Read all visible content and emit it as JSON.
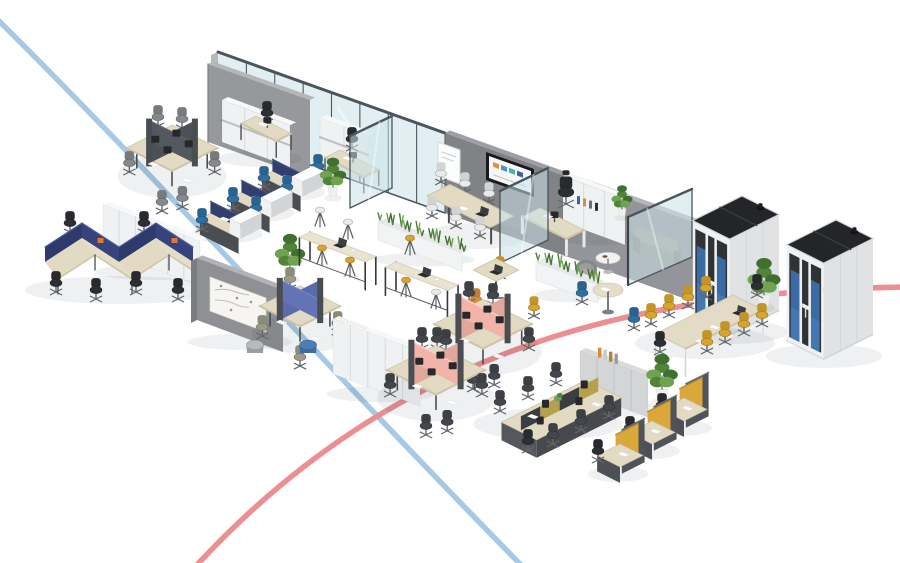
{
  "meta": {
    "width": 900,
    "height": 563,
    "background": "#ffffff"
  },
  "palette": {
    "line_blue": "#a6c9e6",
    "line_red": "#ec8f91",
    "wall_gray": "#94959a",
    "wall_gray_light": "#b7b8bb",
    "wall_dark": "#808286",
    "glass_fill": "rgba(203,226,232,0.55)",
    "glass_frame": "#4b555e",
    "cabinet_white": "#f0f1f2",
    "cabinet_gray": "#d4d5d7",
    "wood": "#e3dac3",
    "wood_dark": "#cdc3a8",
    "frame_dark": "#4a4d52",
    "panel_pink": "#f2b4a8",
    "panel_navy": "#303f6e",
    "panel_periwinkle": "#6273b6",
    "panel_yellow": "#d9a73a",
    "chair_black": "#2c2f33",
    "chair_graphite": "#43474c",
    "chair_gray": "#85888c",
    "chair_blue": "#2f6f9e",
    "chair_yellow": "#d9a42b",
    "chair_white": "#e9eaea",
    "chair_olive": "#9c9b88",
    "chair_orange": "#d98b3a",
    "pod_shell": "#eceeef",
    "pod_top": "#232528",
    "pod_interior": "#303336",
    "sofa_blue": "#3a6ba5",
    "sofa_gray": "#95998f",
    "plant_dark": "#40702e",
    "plant_mid": "#538338",
    "plant_light": "#6fa352",
    "shadow": "rgba(35,40,50,0.07)",
    "tv_colors": [
      "#e2923f",
      "#4f8fd4",
      "#46b5ae",
      "#3b5fa0"
    ]
  },
  "overlay_lines": [
    {
      "name": "blue-route-line",
      "color": "#a6c9e6",
      "width": 5.5,
      "path": "M -4 18 C 150 170 320 360 522 566"
    },
    {
      "name": "red-route-line",
      "color": "#ec8f91",
      "width": 5.5,
      "path": "M 904 287 C 640 292 400 345 196 566"
    }
  ],
  "zones": [
    {
      "type": "backwall",
      "name": "back-wall-glass-offices",
      "x": 218,
      "y": 52,
      "slope": 0.357,
      "h": 80,
      "segments": [
        {
          "kind": "glass",
          "len": 227
        },
        {
          "kind": "dark",
          "len": 120
        },
        {
          "kind": "gray",
          "len": 127
        }
      ]
    },
    {
      "type": "tv",
      "name": "wall-tv-screen",
      "x": 486,
      "y": 152
    },
    {
      "type": "wallpatch",
      "name": "office-back-wall-panel",
      "pts": [
        [
          208,
          64
        ],
        [
          310,
          100
        ],
        [
          310,
          178
        ],
        [
          208,
          142
        ]
      ]
    },
    {
      "type": "cabinet",
      "name": "office1-storage-cabinet",
      "o": [
        222,
        142
      ],
      "w": 68,
      "h": 42,
      "doors": 3,
      "color": "cabinet_white",
      "band": true
    },
    {
      "type": "desk",
      "name": "office1-desk",
      "t": [
        256,
        116
      ],
      "du": 40,
      "dv": 17,
      "chair": {
        "x": 267,
        "y": 122,
        "color": "chair_black"
      }
    },
    {
      "type": "cabinet",
      "name": "office2-storage-cabinet",
      "o": [
        320,
        158
      ],
      "w": 48,
      "h": 40,
      "doors": 2,
      "color": "cabinet_white",
      "band": true
    },
    {
      "type": "desk",
      "name": "office2-desk",
      "t": [
        340,
        150
      ],
      "du": 44,
      "dv": 17,
      "chair": {
        "x": 352,
        "y": 148,
        "color": "chair_black"
      }
    },
    {
      "type": "glasspane",
      "name": "meeting-room-glass-partition",
      "a": [
        392,
        188
      ],
      "b": [
        350,
        208
      ],
      "h": 72
    },
    {
      "type": "whiteboard",
      "name": "meeting-room-flipchart",
      "x": 438,
      "y": 176
    },
    {
      "type": "meetingtable",
      "name": "meeting-room-table",
      "c": [
        470,
        232
      ]
    },
    {
      "type": "cabinet",
      "name": "executive-office-cabinet",
      "o": [
        563,
        222
      ],
      "w": 62,
      "h": 46,
      "doors": 3,
      "color": "cabinet_white",
      "books": true
    },
    {
      "type": "desk",
      "name": "executive-desk",
      "t": [
        540,
        208
      ],
      "du": 50,
      "dv": 20,
      "exec": true,
      "chair": {
        "x": 566,
        "y": 204,
        "color": "chair_black",
        "s": 1.25
      }
    },
    {
      "type": "sofa",
      "name": "executive-sofa",
      "x": 636,
      "y": 252
    },
    {
      "type": "plant",
      "name": "executive-plant",
      "x": 622,
      "y": 216,
      "s": 0.8
    },
    {
      "type": "glasspane",
      "name": "executive-glass-left",
      "a": [
        548,
        240
      ],
      "b": [
        500,
        263
      ],
      "h": 72
    },
    {
      "type": "glasspane",
      "name": "executive-glass-front",
      "a": [
        628,
        285
      ],
      "b": [
        692,
        257
      ],
      "h": 68,
      "post": true
    },
    {
      "type": "coffeetable",
      "name": "lounge-coffee-table",
      "x": 608,
      "y": 272
    },
    {
      "type": "armchair",
      "name": "lounge-armchair",
      "x": 586,
      "y": 282
    },
    {
      "type": "pod",
      "name": "acoustic-pod-left",
      "o": [
        742,
        292
      ]
    },
    {
      "type": "plant",
      "name": "pods-plant",
      "x": 764,
      "y": 306,
      "s": 1.25
    },
    {
      "type": "pod",
      "name": "acoustic-pod-right",
      "o": [
        836,
        316
      ]
    },
    {
      "type": "crosspod",
      "name": "workstation-cluster-nw",
      "c": [
        172,
        168
      ],
      "s": 52,
      "panel": "#53575e",
      "chair": "chair_gray",
      "monitors": true
    },
    {
      "type": "steprow",
      "name": "workstation-row-blue",
      "units": [
        [
          283,
          166
        ],
        [
          252,
          187
        ],
        [
          221,
          208
        ]
      ],
      "chair": "chair_blue"
    },
    {
      "type": "plant",
      "name": "plant-center-left",
      "x": 333,
      "y": 196,
      "s": 1.0
    },
    {
      "type": "cabinet",
      "name": "storage-row-left",
      "o": [
        103,
        250
      ],
      "w": 97,
      "h": 45,
      "doors": 6,
      "color": "cabinet_white"
    },
    {
      "type": "zigzag",
      "name": "zigzag-bench-desks"
    },
    {
      "type": "mapwall",
      "name": "freestanding-wall-whiteboard",
      "o": [
        197,
        258
      ]
    },
    {
      "type": "plant",
      "name": "plant-hub",
      "x": 290,
      "y": 278,
      "s": 1.15
    },
    {
      "type": "crosspod",
      "name": "workstation-trio-hub",
      "c": [
        300,
        326
      ],
      "s": 46,
      "panel": "panel_periwinkle",
      "chair": "chair_olive",
      "three": true
    },
    {
      "type": "ottoman",
      "name": "ottoman-gray",
      "x": 255,
      "y": 352,
      "color": "#b9babc"
    },
    {
      "type": "ottoman",
      "name": "ottoman-blue",
      "x": 308,
      "y": 352,
      "color": "#4a7fb5"
    },
    {
      "type": "cabinet",
      "name": "storage-row-center",
      "o": [
        333,
        374
      ],
      "w": 87,
      "h": 55,
      "doors": 5,
      "color": "cabinet_white",
      "trays": true
    },
    {
      "type": "planter",
      "name": "planter-long",
      "o": [
        378,
        222
      ],
      "w": 84
    },
    {
      "type": "bartable",
      "name": "high-table-1",
      "x": 310,
      "y": 232,
      "len": 70,
      "stools": [
        [
          320,
          224,
          "chair_white"
        ],
        [
          348,
          236,
          "chair_white"
        ],
        [
          322,
          262,
          "chair_yellow"
        ],
        [
          350,
          274,
          "chair_yellow"
        ]
      ]
    },
    {
      "type": "bartable",
      "name": "high-table-2",
      "x": 396,
      "y": 262,
      "len": 66,
      "stools": [
        [
          410,
          252,
          "chair_yellow"
        ],
        [
          406,
          294,
          "chair_yellow"
        ],
        [
          436,
          306,
          "chair_white"
        ]
      ]
    },
    {
      "type": "planter",
      "name": "planter-short",
      "o": [
        536,
        262
      ],
      "w": 62
    },
    {
      "type": "smalltable",
      "name": "cafe-table",
      "x": 496,
      "y": 296,
      "chairs": [
        [
          500,
          276,
          "chair_yellow"
        ],
        [
          534,
          316,
          "chair_yellow"
        ],
        [
          476,
          308,
          "chair_orange"
        ]
      ]
    },
    {
      "type": "roundtable",
      "name": "breakout-round-table",
      "x": 608,
      "y": 314,
      "chairs": [
        [
          582,
          302,
          "chair_blue"
        ],
        [
          634,
          328,
          "chair_blue"
        ]
      ]
    },
    {
      "type": "longtable",
      "name": "large-meeting-table",
      "o": [
        733,
        295
      ]
    },
    {
      "type": "crosspod",
      "name": "workstation-cluster-pink-a",
      "c": [
        483,
        344
      ],
      "s": 56,
      "panel": "panel_pink",
      "chair": "chair_graphite",
      "monitors": true
    },
    {
      "type": "crosspod",
      "name": "workstation-cluster-pink-b",
      "c": [
        436,
        390
      ],
      "s": 56,
      "panel": "panel_pink",
      "chair": "chair_graphite",
      "monitors": true
    },
    {
      "type": "cabinet",
      "name": "storage-gray",
      "o": [
        580,
        392
      ],
      "w": 68,
      "h": 41,
      "doors": 4,
      "color": "cabinet_gray",
      "binders": true
    },
    {
      "type": "plant",
      "name": "plant-bench",
      "x": 662,
      "y": 400,
      "s": 1.2
    },
    {
      "type": "bench",
      "name": "bench-workstations",
      "o": [
        586,
        380
      ]
    },
    {
      "type": "yellowrow",
      "name": "workstation-row-yellow",
      "units": [
        [
          684,
          398
        ],
        [
          652,
          421
        ],
        [
          620,
          444
        ]
      ]
    }
  ]
}
